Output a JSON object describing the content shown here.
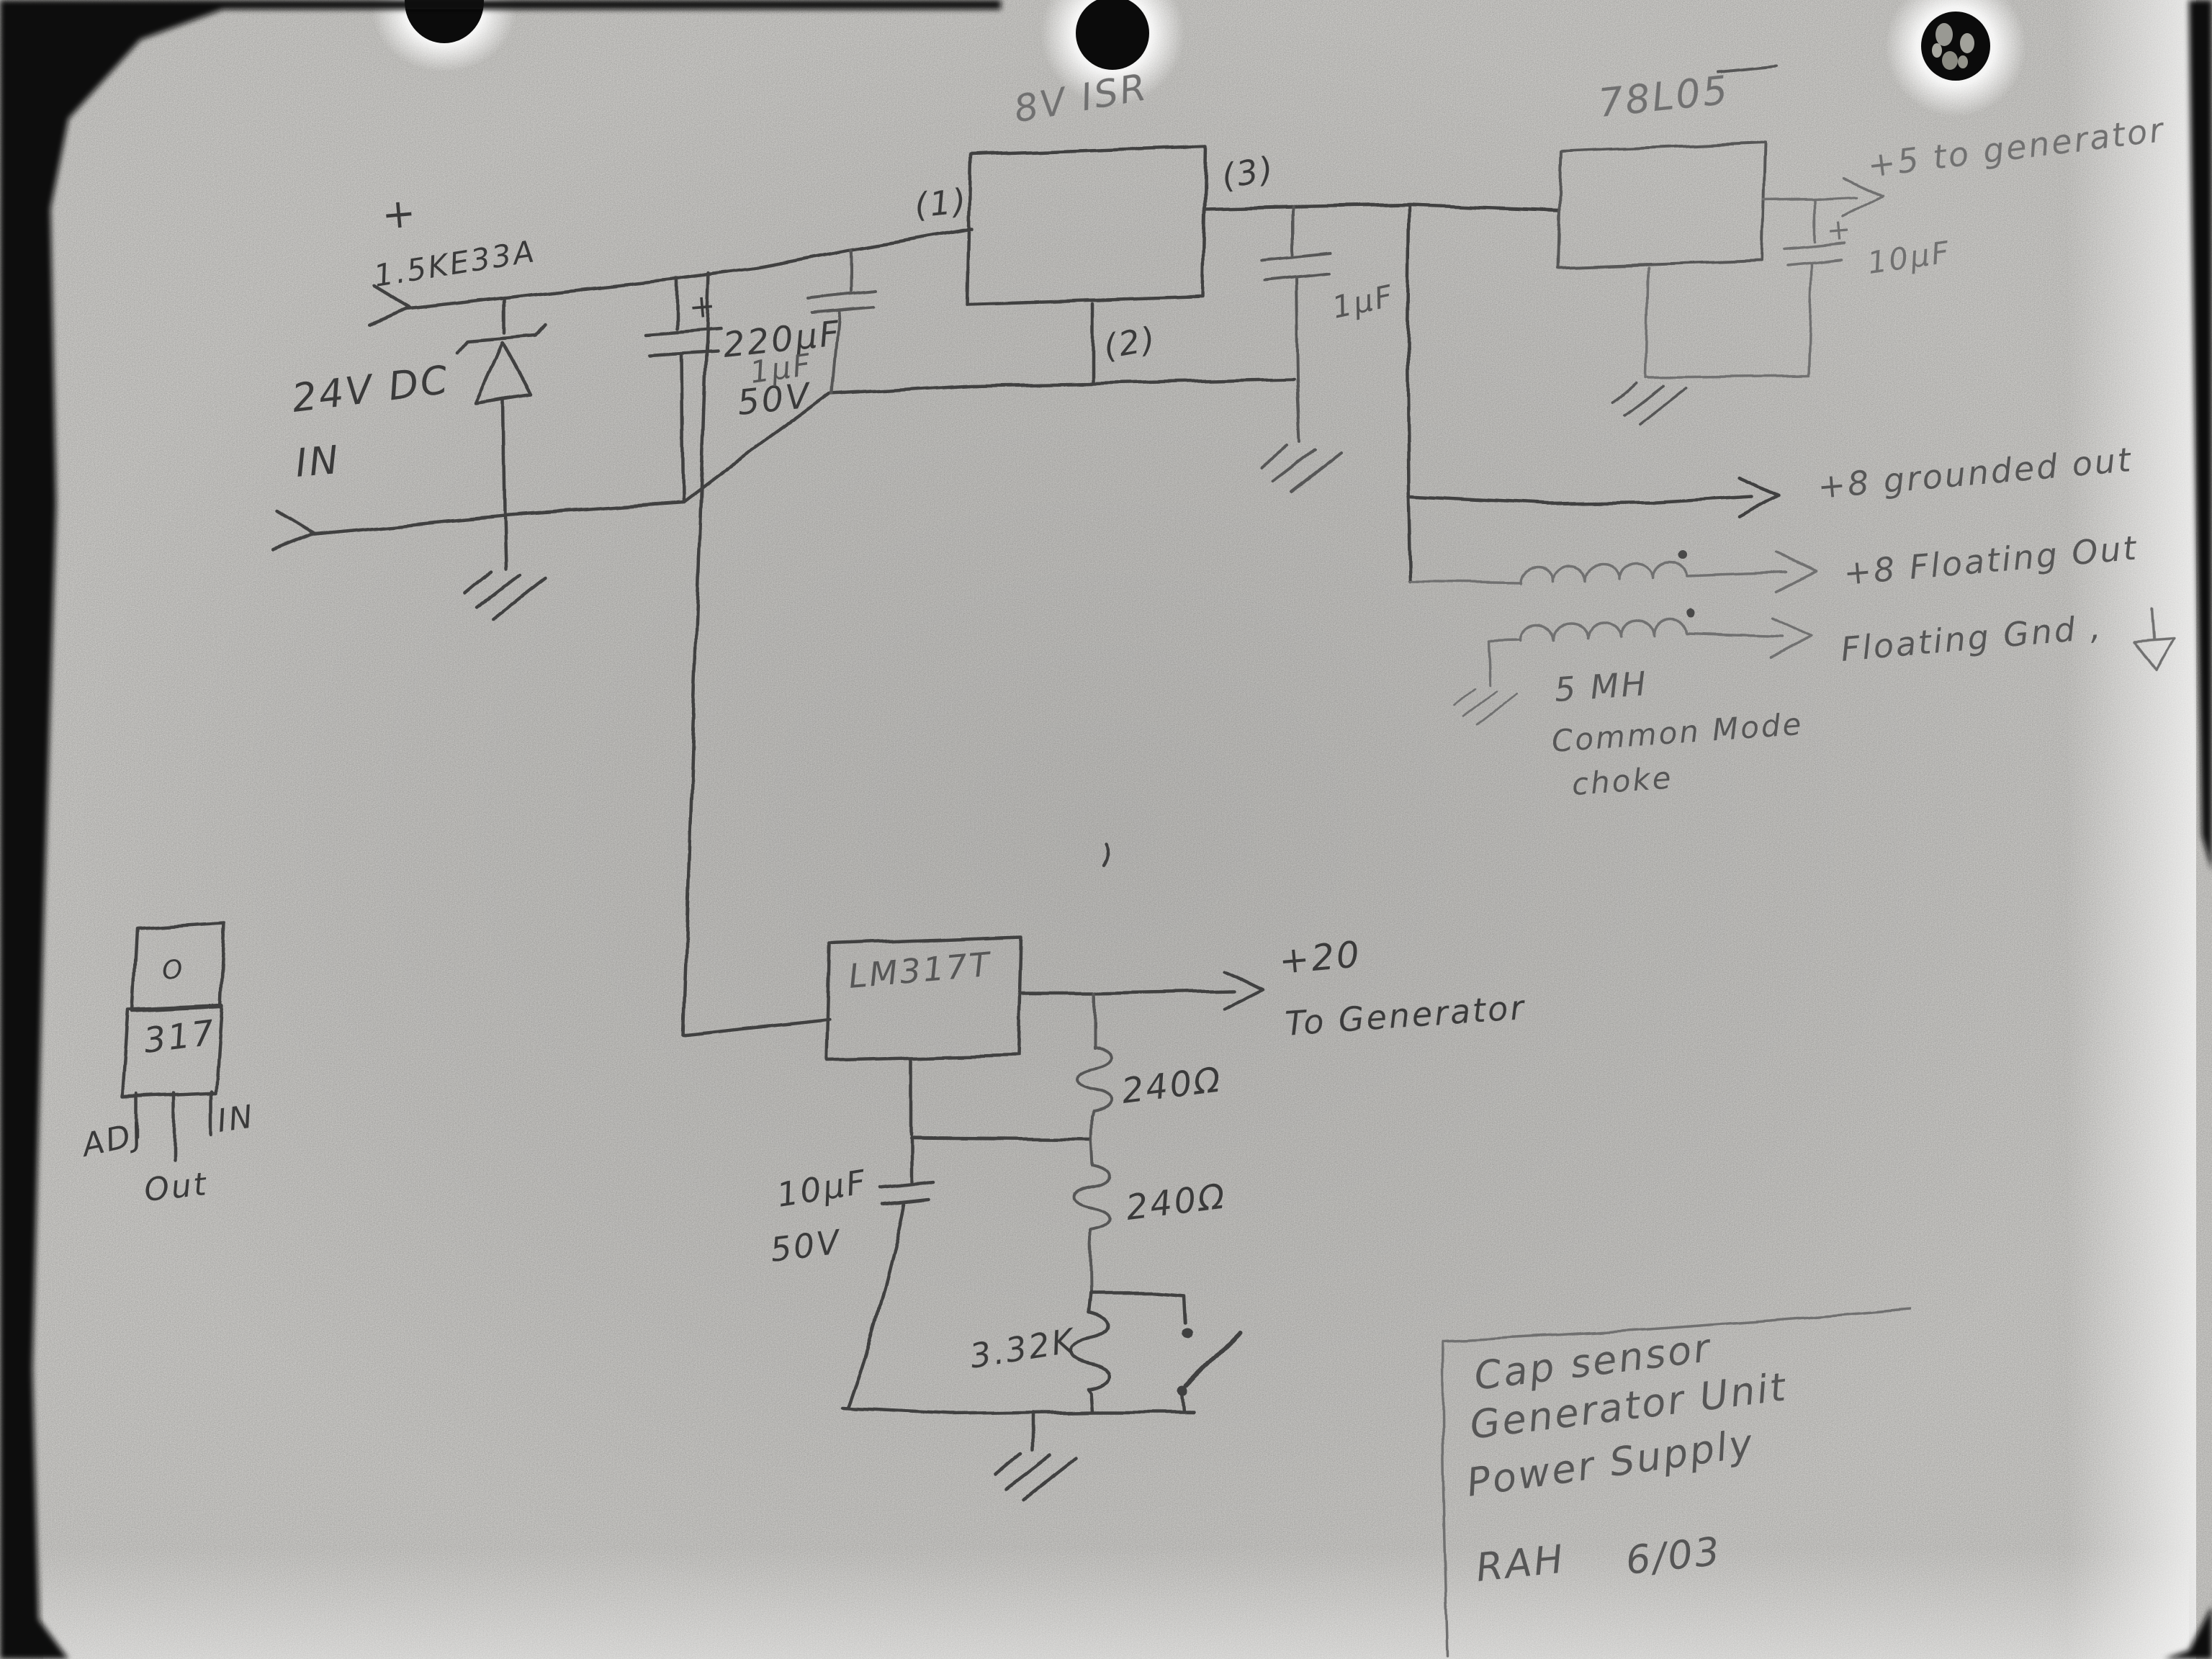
{
  "colors": {
    "paper": "#c9c8c5",
    "pencil_dark": "#3a3a3a",
    "pencil_mid": "#565656",
    "pencil_light": "#707070"
  },
  "symbols": {
    "plus": "+"
  },
  "input": {
    "plus": "+",
    "voltage": "24V DC",
    "port": "IN",
    "tvs": "1.5KE33A",
    "bulk_cap": "220µF",
    "bulk_cap_voltage": "50V"
  },
  "isolator": {
    "title": "8V ISR",
    "pin1": "(1)",
    "pin2": "(2)",
    "pin3": "(3)",
    "input_cap": "1µF",
    "output_cap": "1µF"
  },
  "reg5v": {
    "name": "78L05",
    "cap": "10µF",
    "cap_plus": "+",
    "output": "+5 to generator"
  },
  "outputs8v": {
    "grounded": "+8 grounded out",
    "floating": "+8 Floating Out",
    "floating_gnd": "Floating Gnd ,",
    "choke_value": "5 MH",
    "choke_line1": "Common Mode",
    "choke_line2": "choke"
  },
  "reg20v": {
    "name": "LM317T",
    "output": "+20",
    "destination": "To Generator",
    "r_top": "240Ω",
    "r_mid": "240Ω",
    "r_bottom": "3.32K",
    "cap": "10µF",
    "cap_voltage": "50V"
  },
  "package317": {
    "tab": "O",
    "body": "317",
    "pin_adj": "ADJ",
    "pin_in": "IN",
    "pin_out": "Out"
  },
  "title_block": {
    "line1": "Cap sensor",
    "line2": "Generator Unit",
    "line3": "Power Supply",
    "author": "RAH",
    "date": "6/03"
  }
}
